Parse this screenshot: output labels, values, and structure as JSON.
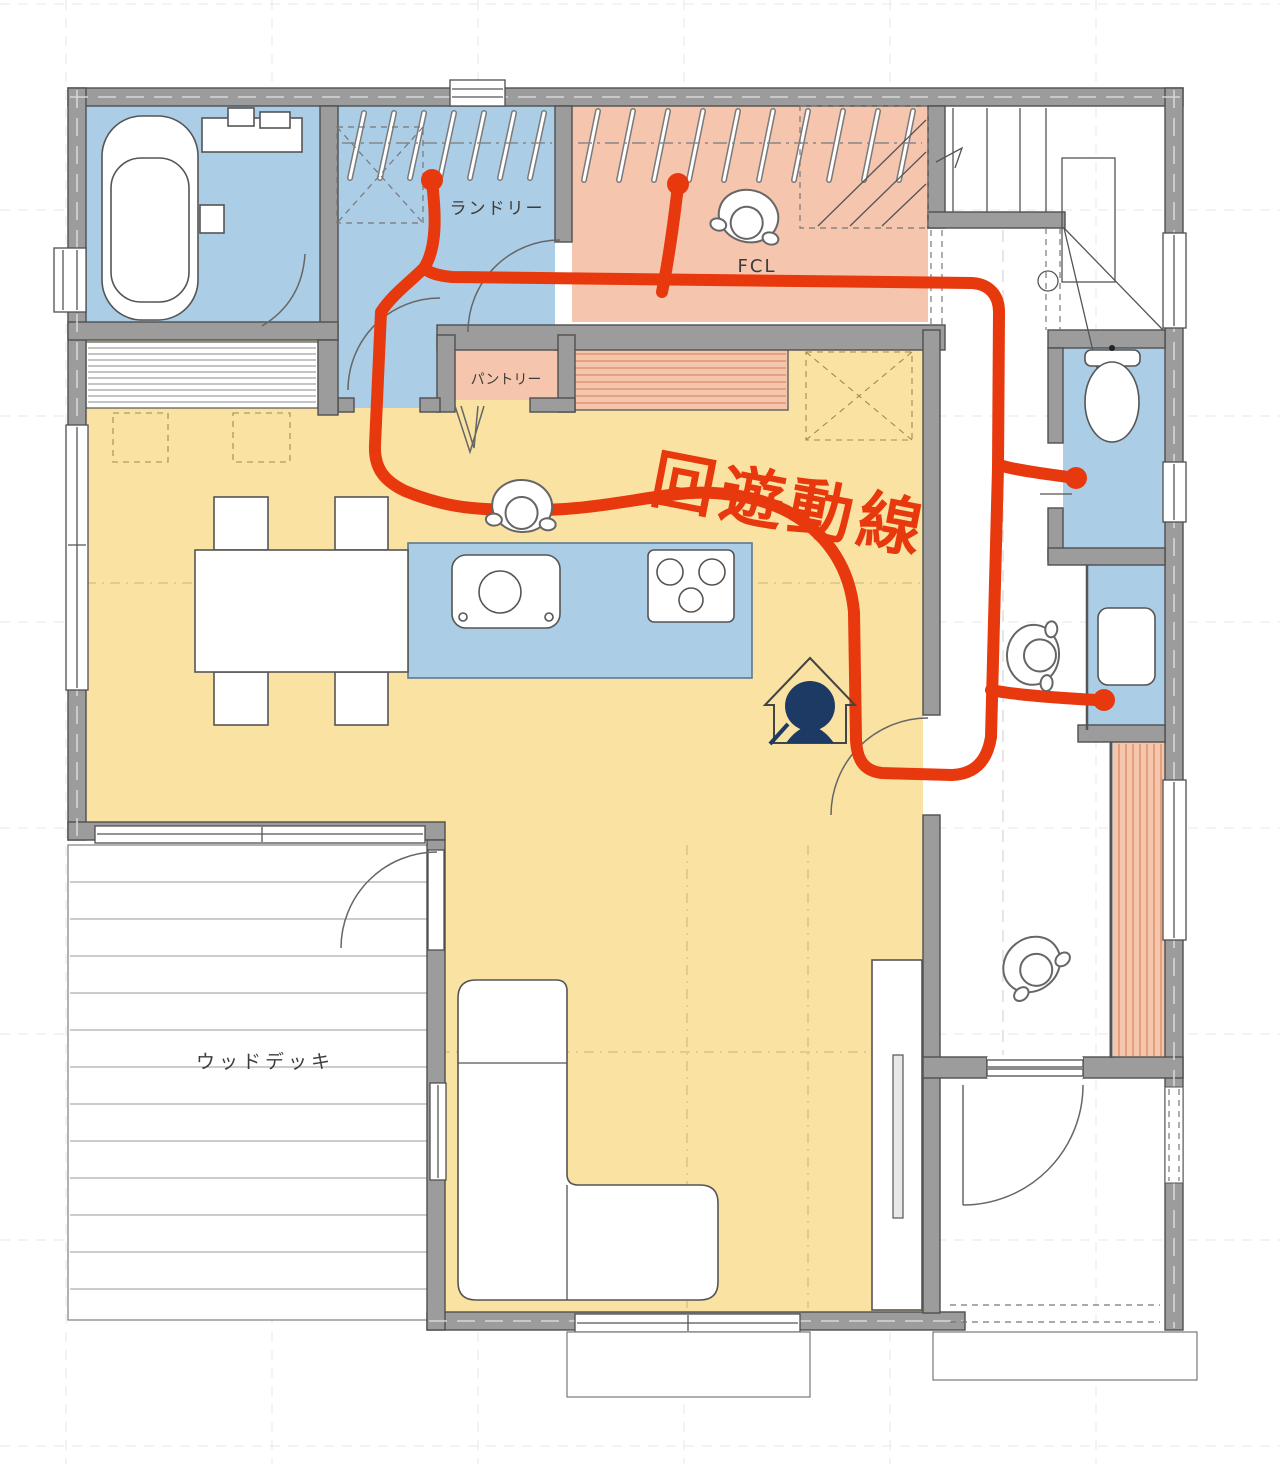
{
  "plan": {
    "labels": {
      "laundry": "ランドリー",
      "family_closet": "FCL",
      "pantry": "パントリー",
      "wood_deck": "ウッドデッキ",
      "flow_annotation": "回遊動線"
    },
    "colors": {
      "wet_area_blue": "#abcde5",
      "closet_salmon": "#f6c5ad",
      "floor_yellow": "#fae2a2",
      "accent_stripe": "#dd9671",
      "wall_gray": "#9c9c9c",
      "flow_red": "#e8380d",
      "mascot_navy": "#1c3a63"
    },
    "icons": {
      "person": "person-top-view-icon",
      "mascot": "child-in-house-icon",
      "fixtures": "bathtub-icon, toilet-icon, kitchen-sink-icon, stove-icon, washbasin-icon, sofa-icon, dining-table-icon, stairs-icon"
    }
  }
}
